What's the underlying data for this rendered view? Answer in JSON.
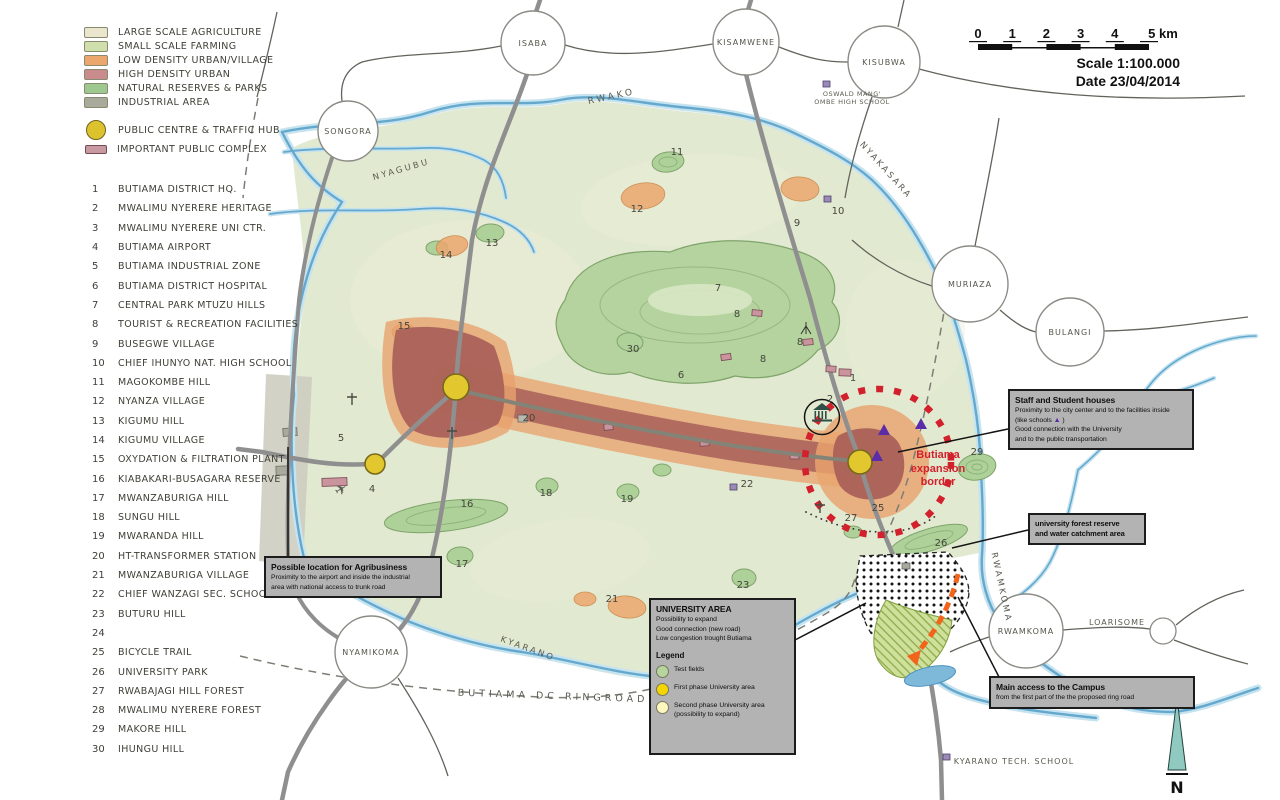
{
  "scalebar": {
    "ticks": [
      "0",
      "1",
      "2",
      "3",
      "4"
    ],
    "end_label": "5 km",
    "scale_text": "Scale 1:100.000",
    "date_text": "Date 23/04/2014"
  },
  "legend": {
    "items": [
      {
        "shape": "rect",
        "color": "#e9e6cd",
        "label": "LARGE SCALE AGRICULTURE"
      },
      {
        "shape": "rect",
        "color": "#cfe0ac",
        "label": "SMALL SCALE FARMING"
      },
      {
        "shape": "rect",
        "color": "#eba76e",
        "label": "LOW DENSITY URBAN/VILLAGE"
      },
      {
        "shape": "rect",
        "color": "#c98b8b",
        "label": "HIGH DENSITY URBAN"
      },
      {
        "shape": "rect",
        "color": "#9dc88f",
        "label": "NATURAL RESERVES & PARKS"
      },
      {
        "shape": "rect",
        "color": "#a9a99c",
        "label": "INDUSTRIAL AREA"
      },
      {
        "shape": "circle",
        "color": "#dcc32e",
        "label": "PUBLIC CENTRE & TRAFFIC HUB"
      },
      {
        "shape": "rect-small",
        "color": "#c79aa2",
        "label": "IMPORTANT PUBLIC COMPLEX"
      }
    ]
  },
  "locations": [
    {
      "num": "1",
      "label": "BUTIAMA DISTRICT HQ."
    },
    {
      "num": "2",
      "label": "MWALIMU NYERERE HERITAGE"
    },
    {
      "num": "3",
      "label": "MWALIMU NYERERE UNI CTR."
    },
    {
      "num": "4",
      "label": "BUTIAMA AIRPORT"
    },
    {
      "num": "5",
      "label": "BUTIAMA INDUSTRIAL ZONE"
    },
    {
      "num": "6",
      "label": "BUTIAMA DISTRICT HOSPITAL"
    },
    {
      "num": "7",
      "label": "CENTRAL PARK MTUZU HILLS"
    },
    {
      "num": "8",
      "label": "TOURIST & RECREATION FACILITIES"
    },
    {
      "num": "9",
      "label": "BUSEGWE VILLAGE"
    },
    {
      "num": "10",
      "label": "CHIEF IHUNYO NAT. HIGH SCHOOL"
    },
    {
      "num": "11",
      "label": "MAGOKOMBE HILL"
    },
    {
      "num": "12",
      "label": "NYANZA VILLAGE"
    },
    {
      "num": "13",
      "label": "KIGUMU HILL"
    },
    {
      "num": "14",
      "label": "KIGUMU VILLAGE"
    },
    {
      "num": "15",
      "label": "OXYDATION & FILTRATION PLANT"
    },
    {
      "num": "16",
      "label": "KIABAKARI-BUSAGARA RESERVE"
    },
    {
      "num": "17",
      "label": "MWANZABURIGA HILL"
    },
    {
      "num": "18",
      "label": "SUNGU HILL"
    },
    {
      "num": "19",
      "label": "MWARANDA HILL"
    },
    {
      "num": "20",
      "label": "HT-TRANSFORMER STATION"
    },
    {
      "num": "21",
      "label": "MWANZABURIGA VILLAGE"
    },
    {
      "num": "22",
      "label": "CHIEF WANZAGI SEC. SCHOOL"
    },
    {
      "num": "23",
      "label": "BUTURU HILL"
    },
    {
      "num": "24",
      "label": ""
    },
    {
      "num": "25",
      "label": "BICYCLE TRAIL"
    },
    {
      "num": "26",
      "label": "UNIVERSITY PARK"
    },
    {
      "num": "27",
      "label": "RWABAJAGI HILL FOREST"
    },
    {
      "num": "28",
      "label": "MWALIMU NYERERE FOREST"
    },
    {
      "num": "29",
      "label": "MAKORE HILL"
    },
    {
      "num": "30",
      "label": "IHUNGU HILL"
    }
  ],
  "callouts": {
    "staff_houses": {
      "title": "Staff and Student houses",
      "line1": "Proximity to the city center and to the facilities inside",
      "like_pre": "(like schools ",
      "triangle": "▲",
      "like_post": " )",
      "line3": "Good connection with the University",
      "line4": "and to the public transportation"
    },
    "forest_reserve": {
      "line1": "university forest reserve",
      "line2": "and water catchment area"
    },
    "agribusiness": {
      "title": "Possible location for Agribusiness",
      "line1": "Proximity to the airport and inside the industrial",
      "line2": "area with national access to trunk road"
    },
    "university": {
      "title": "UNIVERSITY AREA",
      "line1": "Possibility to expand",
      "line2": "Good connection (new road)",
      "line3": "Low congestion trought Butiama",
      "legend_title": "Legend",
      "items": [
        {
          "color": "#b5d49e",
          "label": "Test fields",
          "label2": ""
        },
        {
          "color": "#f5d500",
          "label": "First phase University area",
          "label2": ""
        },
        {
          "color": "#fdf6bf",
          "label": "Second phase University area",
          "label2": "(possibility to expand)"
        }
      ]
    },
    "access": {
      "title": "Main access to the Campus",
      "line1": "from the first part of the the proposed  ring road"
    }
  },
  "expansion_border": {
    "line1": "Butiama",
    "line2": "expansion",
    "line3": "border"
  },
  "compass": {
    "label": "N"
  },
  "map": {
    "places": [
      {
        "name": "ISABA",
        "x": 533,
        "y": 43,
        "r": 32
      },
      {
        "name": "KISAMWENE",
        "x": 746,
        "y": 42,
        "r": 33
      },
      {
        "name": "KISUBWA",
        "x": 884,
        "y": 62,
        "r": 36
      },
      {
        "name": "SONGORA",
        "x": 348,
        "y": 131,
        "r": 30
      },
      {
        "name": "MURIAZA",
        "x": 970,
        "y": 284,
        "r": 38
      },
      {
        "name": "BULANGI",
        "x": 1070,
        "y": 332,
        "r": 34
      },
      {
        "name": "NYAMIKOMA",
        "x": 371,
        "y": 652,
        "r": 36
      },
      {
        "name": "RWAMKOMA",
        "x": 1026,
        "y": 631,
        "r": 37
      }
    ],
    "labels": [
      {
        "text": "RWAKO",
        "x": 612,
        "y": 99,
        "rot": -12,
        "fs": 9,
        "ls": 3
      },
      {
        "text": "NYAGUBU",
        "x": 402,
        "y": 172,
        "rot": -16,
        "fs": 8.5,
        "ls": 2.5
      },
      {
        "text": "NYAKASARA",
        "x": 884,
        "y": 172,
        "rot": 48,
        "fs": 8.5,
        "ls": 2.5
      },
      {
        "text": "RWAMKOMA",
        "x": 999,
        "y": 588,
        "rot": 78,
        "fs": 8.5,
        "ls": 2.5
      },
      {
        "text": "KYARANO",
        "x": 527,
        "y": 651,
        "rot": 20,
        "fs": 8.5,
        "ls": 2.5
      },
      {
        "text": "BUTIAMA DC RINGROAD",
        "x": 553,
        "y": 699,
        "rot": 2,
        "fs": 9.5,
        "ls": 4
      },
      {
        "text": "KYARANO TECH. SCHOOL",
        "x": 1014,
        "y": 764,
        "rot": 0,
        "fs": 8,
        "ls": 1
      },
      {
        "text": "OSWALD MANG'",
        "x": 852,
        "y": 96,
        "rot": 0,
        "fs": 6.5,
        "ls": 0.5
      },
      {
        "text": "OMBE HIGH SCHOOL",
        "x": 852,
        "y": 104,
        "rot": 0,
        "fs": 6.5,
        "ls": 0.5
      },
      {
        "text": "LOARISOME",
        "x": 1117,
        "y": 625,
        "rot": 0,
        "fs": 8,
        "ls": 1
      }
    ],
    "numbers": [
      {
        "n": "1",
        "x": 853,
        "y": 381
      },
      {
        "n": "2",
        "x": 830,
        "y": 402
      },
      {
        "n": "4",
        "x": 372,
        "y": 492
      },
      {
        "n": "5",
        "x": 341,
        "y": 441
      },
      {
        "n": "6",
        "x": 681,
        "y": 378
      },
      {
        "n": "7",
        "x": 718,
        "y": 291
      },
      {
        "n": "8",
        "x": 737,
        "y": 317
      },
      {
        "n": "8",
        "x": 800,
        "y": 345
      },
      {
        "n": "8",
        "x": 763,
        "y": 362
      },
      {
        "n": "9",
        "x": 797,
        "y": 226
      },
      {
        "n": "10",
        "x": 838,
        "y": 214
      },
      {
        "n": "11",
        "x": 677,
        "y": 155
      },
      {
        "n": "12",
        "x": 637,
        "y": 212
      },
      {
        "n": "13",
        "x": 492,
        "y": 246
      },
      {
        "n": "14",
        "x": 446,
        "y": 258
      },
      {
        "n": "15",
        "x": 404,
        "y": 329
      },
      {
        "n": "16",
        "x": 467,
        "y": 507
      },
      {
        "n": "17",
        "x": 462,
        "y": 567
      },
      {
        "n": "18",
        "x": 546,
        "y": 496
      },
      {
        "n": "19",
        "x": 627,
        "y": 502
      },
      {
        "n": "20",
        "x": 529,
        "y": 421
      },
      {
        "n": "21",
        "x": 612,
        "y": 602
      },
      {
        "n": "22",
        "x": 747,
        "y": 487
      },
      {
        "n": "23",
        "x": 743,
        "y": 588
      },
      {
        "n": "25",
        "x": 878,
        "y": 511
      },
      {
        "n": "26",
        "x": 941,
        "y": 546
      },
      {
        "n": "27",
        "x": 851,
        "y": 521
      },
      {
        "n": "29",
        "x": 977,
        "y": 455
      },
      {
        "n": "30",
        "x": 633,
        "y": 352
      }
    ]
  }
}
